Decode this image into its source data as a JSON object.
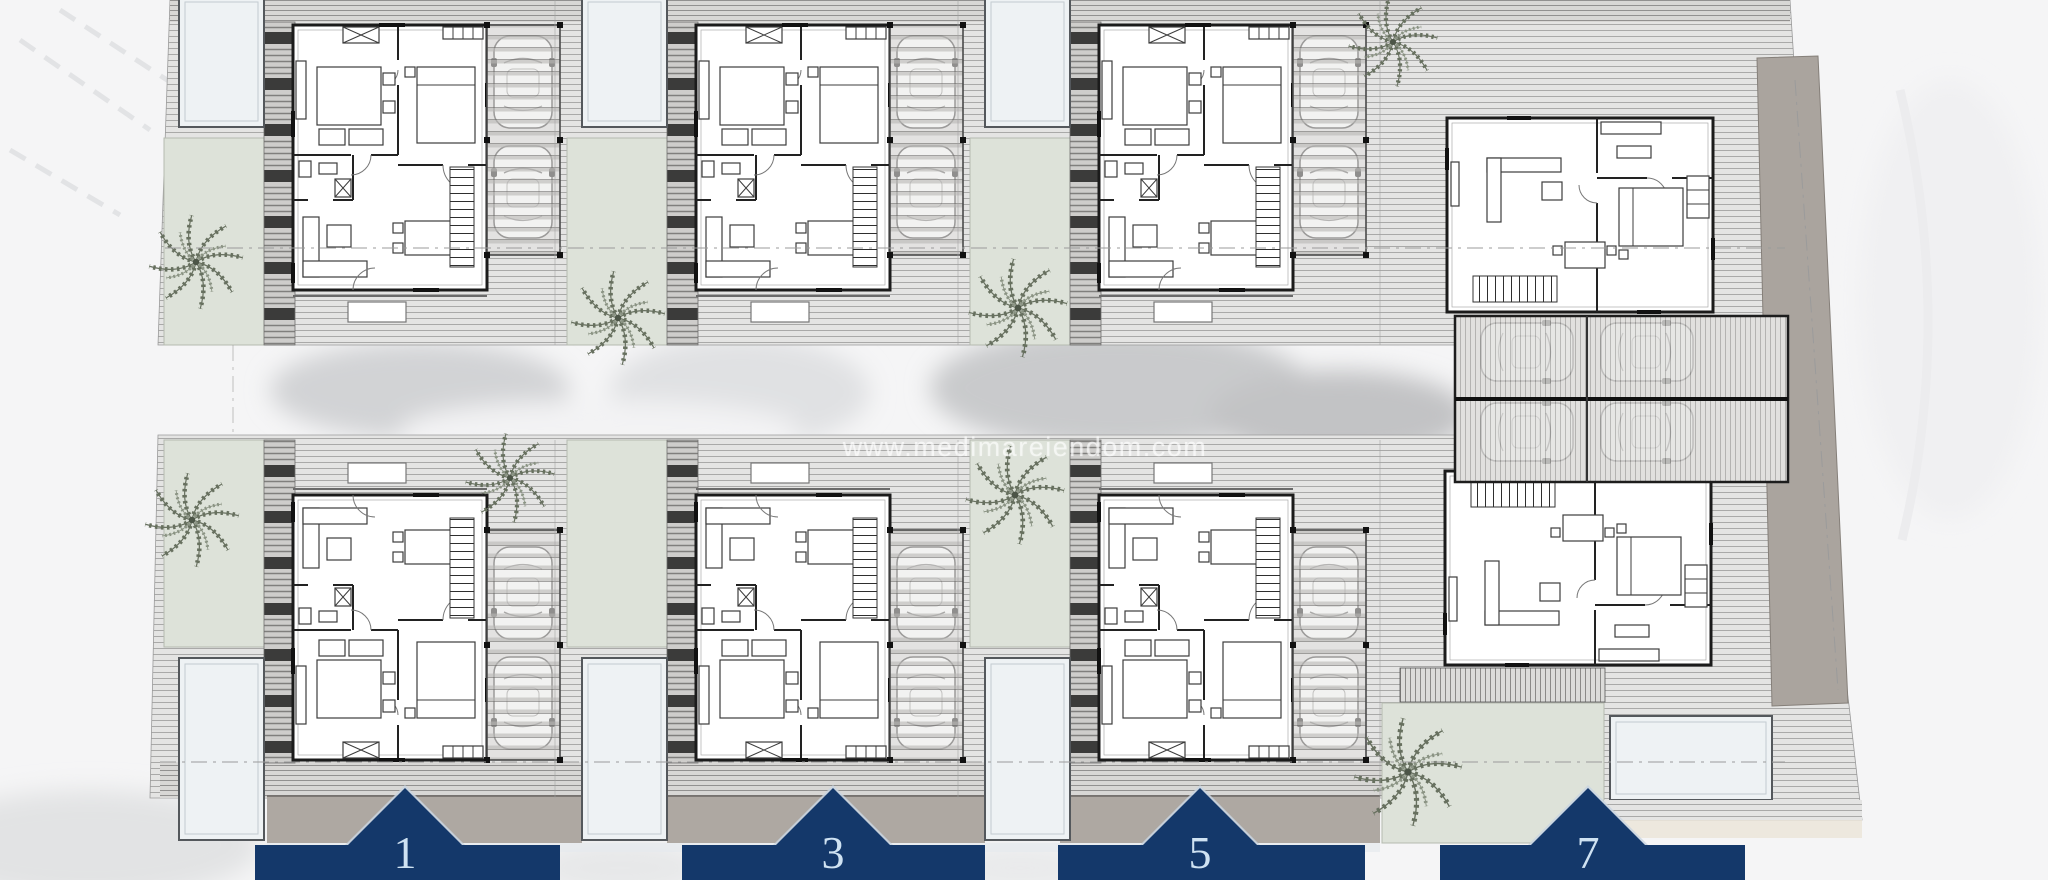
{
  "watermark": {
    "text": "www.medimareiendom.com"
  },
  "units": [
    {
      "number": "1"
    },
    {
      "number": "3"
    },
    {
      "number": "5"
    },
    {
      "number": "7"
    }
  ],
  "colors": {
    "banner_navy": "#14386a",
    "banner_number": "#cfe2f2",
    "garden": "#dde2d9",
    "pool": "#eef2f4",
    "driveway": "#aaa49e"
  }
}
